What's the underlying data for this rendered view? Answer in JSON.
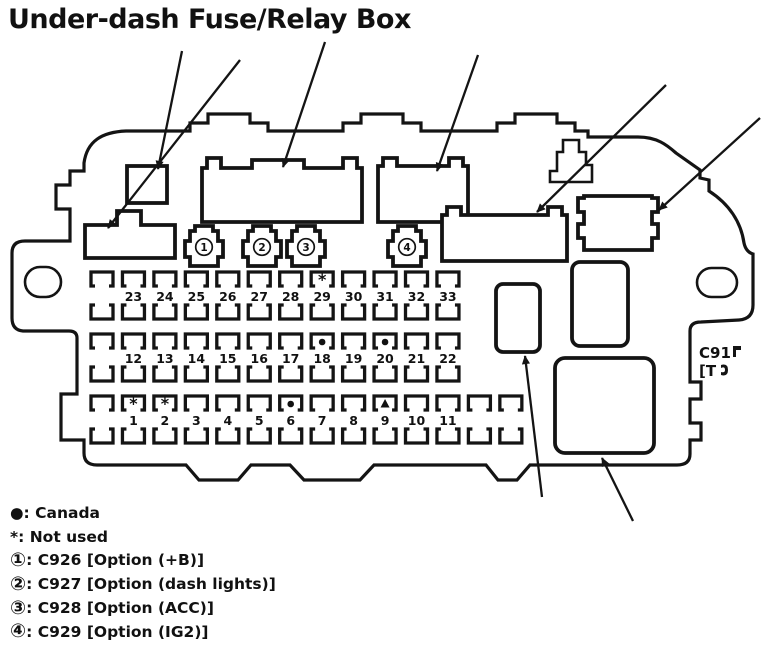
{
  "title": "Under-dash Fuse/Relay Box",
  "diagram": {
    "right_label_line1": "C91",
    "right_label_line2": "[T",
    "plug_labels": [
      "1",
      "2",
      "3",
      "4"
    ],
    "fuse_rows": [
      {
        "labels": [
          "23",
          "24",
          "25",
          "26",
          "27",
          "28",
          "29",
          "30",
          "31",
          "32",
          "33"
        ],
        "lead_blanks": 1,
        "trail_blanks": 0
      },
      {
        "labels": [
          "12",
          "13",
          "14",
          "15",
          "16",
          "17",
          "18",
          "19",
          "20",
          "21",
          "22"
        ],
        "lead_blanks": 1,
        "trail_blanks": 0
      },
      {
        "labels": [
          "1",
          "2",
          "3",
          "4",
          "5",
          "6",
          "7",
          "8",
          "9",
          "10",
          "11"
        ],
        "lead_blanks": 1,
        "trail_blanks": 2
      }
    ],
    "fuse_markers": [
      {
        "fuse": "29",
        "symbol": "asterisk"
      },
      {
        "fuse": "18",
        "symbol": "dot"
      },
      {
        "fuse": "20",
        "symbol": "dot"
      },
      {
        "fuse": "1",
        "symbol": "asterisk"
      },
      {
        "fuse": "2",
        "symbol": "asterisk"
      },
      {
        "fuse": "6",
        "symbol": "dot"
      },
      {
        "fuse": "9",
        "symbol": "triangle"
      }
    ]
  },
  "legend": [
    {
      "symbol": "●",
      "text": ": Canada"
    },
    {
      "symbol": "*",
      "text": ": Not used"
    },
    {
      "symbol": "①",
      "text": ": C926 [Option (+B)]"
    },
    {
      "symbol": "②",
      "text": ": C927 [Option (dash lights)]"
    },
    {
      "symbol": "③",
      "text": ": C928 [Option (ACC)]"
    },
    {
      "symbol": "④",
      "text": ": C929 [Option (IG2)]"
    }
  ],
  "colors": {
    "ink": "#141414",
    "background": "#ffffff"
  }
}
